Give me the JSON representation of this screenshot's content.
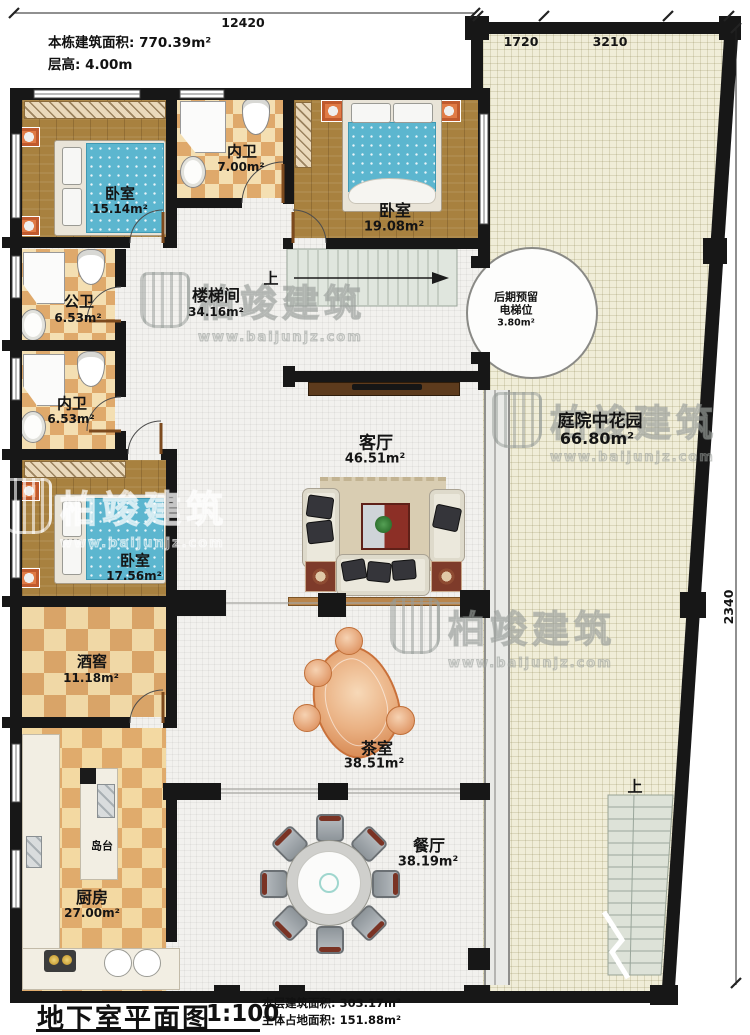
{
  "header": {
    "building_area": "本栋建筑面积: 770.39m²",
    "floor_height": "层高: 4.00m"
  },
  "dimensions": {
    "top": "12420",
    "top_right_a": "1720",
    "top_right_b": "3210",
    "right": "2340"
  },
  "rooms": {
    "bedroom1": {
      "name": "卧室",
      "area": "15.14m²"
    },
    "bath1": {
      "name": "内卫",
      "area": "7.00m²"
    },
    "bedroom2": {
      "name": "卧室",
      "area": "19.08m²"
    },
    "public_bath": {
      "name": "公卫",
      "area": "6.53m²"
    },
    "stairwell": {
      "name": "楼梯间",
      "area": "34.16m²"
    },
    "elevator": {
      "line1": "后期预留",
      "line2": "电梯位",
      "area": "3.80m²"
    },
    "bath2": {
      "name": "内卫",
      "area": "6.53m²"
    },
    "courtyard": {
      "name": "庭院中花园",
      "area": "66.80m²"
    },
    "living": {
      "name": "客厅",
      "area": "46.51m²"
    },
    "bedroom3": {
      "name": "卧室",
      "area": "17.56m²"
    },
    "wine_cellar": {
      "name": "酒窖",
      "area": "11.18m²"
    },
    "tea_room": {
      "name": "茶室",
      "area": "38.51m²"
    },
    "island": {
      "name": "岛台"
    },
    "kitchen": {
      "name": "厨房",
      "area": "27.00m²"
    },
    "dining": {
      "name": "餐厅",
      "area": "38.19m²"
    }
  },
  "stairs": {
    "up_label": "上"
  },
  "footer": {
    "title": "地下室平面图",
    "scale": "1:100",
    "line1": "本层建筑面积: 303.17m²",
    "line2": "主体占地面积: 151.88m²"
  },
  "watermark": {
    "brand": "柏竣建筑",
    "url": "www.baijunjz.com"
  }
}
